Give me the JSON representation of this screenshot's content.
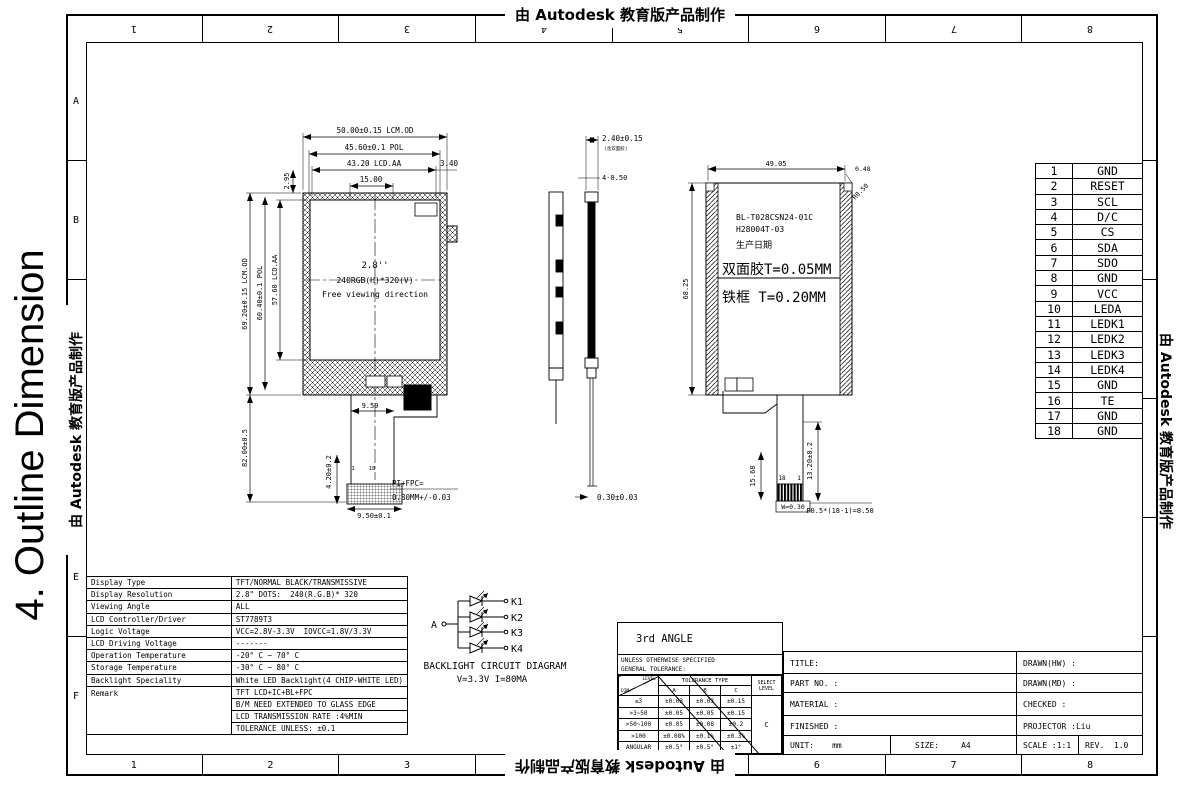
{
  "sheet": {
    "big_title": "4. Outline Dimension",
    "watermark": "由 Autodesk 教育版产品制作",
    "cols": [
      "1",
      "2",
      "3",
      "4",
      "5",
      "6",
      "7",
      "8"
    ],
    "rows": [
      "A",
      "B",
      "C",
      "D",
      "E",
      "F"
    ]
  },
  "front": {
    "dim_w_od": "50.00±0.15 LCM.OD",
    "dim_w_pol": "45.60±0.1 POL",
    "dim_w_aa": "43.20 LCD.AA",
    "dim_offset": "3.40",
    "dim_ledge": "15.00",
    "dim_top_gap": "2.95",
    "dim_h_od": "69.20±0.15 LCM.OD",
    "dim_h_pol": "60.40±0.1 POL",
    "dim_h_aa": "57.60 LCD.AA",
    "dim_h_total": "82.00±0.5",
    "size_label": "2.8''",
    "res_label": "240RGB(H)*320(V)",
    "view_label": "Free viewing direction",
    "dim_fpc_w": "9.50",
    "dim_fpc_h": "4.20±0.2",
    "dim_fpc_w2": "9.50±0.1",
    "fpc_note1": "PI+FPC=",
    "fpc_note2": "0.30MM+/-0.03",
    "pin_first": "1",
    "pin_last": "18"
  },
  "side": {
    "dim_thickness": "2.40±0.15",
    "dim_thickness_note": "(含双面胶)",
    "dim_bumps": "4-0.50",
    "dim_fpc_t": "0.30±0.03"
  },
  "rear": {
    "dim_top": "49.05",
    "dim_corner": "0.48",
    "dim_radius": "R0.50",
    "dim_left": "68.25",
    "model1": "BL-T028CSN24-01C",
    "model2": "H28004T-03",
    "model3": "生产日期",
    "tape": "双面胶T=0.05MM",
    "frame": "铁框 T=0.20MM",
    "dim_tail": "15.68",
    "dim_tail2": "13.20±0.2",
    "pin_left": "18",
    "pin_right": "1",
    "dim_w": "W=0.30",
    "dim_pitch": "P0.5*(18-1)=8.50"
  },
  "pins": [
    {
      "no": "1",
      "name": "GND"
    },
    {
      "no": "2",
      "name": "RESET"
    },
    {
      "no": "3",
      "name": "SCL"
    },
    {
      "no": "4",
      "name": "D/C"
    },
    {
      "no": "5",
      "name": "CS"
    },
    {
      "no": "6",
      "name": "SDA"
    },
    {
      "no": "7",
      "name": "SDO"
    },
    {
      "no": "8",
      "name": "GND"
    },
    {
      "no": "9",
      "name": "VCC"
    },
    {
      "no": "10",
      "name": "LEDA"
    },
    {
      "no": "11",
      "name": "LEDK1"
    },
    {
      "no": "12",
      "name": "LEDK2"
    },
    {
      "no": "13",
      "name": "LEDK3"
    },
    {
      "no": "14",
      "name": "LEDK4"
    },
    {
      "no": "15",
      "name": "GND"
    },
    {
      "no": "16",
      "name": "TE"
    },
    {
      "no": "17",
      "name": "GND"
    },
    {
      "no": "18",
      "name": "GND"
    }
  ],
  "specs": {
    "rows": [
      {
        "label": "Display Type",
        "value": "TFT/NORMAL BLACK/TRANSMISSIVE"
      },
      {
        "label": "Display Resolution",
        "value": "2.8\" DOTS:  240(R.G.B)* 320"
      },
      {
        "label": "Viewing Angle",
        "value": "ALL"
      },
      {
        "label": "LCD Controller/Driver",
        "value": "ST7789T3"
      },
      {
        "label": "Logic Voltage",
        "value": "VCC=2.8V-3.3V  IOVCC=1.8V/3.3V"
      },
      {
        "label": "LCD Driving Voltage",
        "value": "-------"
      },
      {
        "label": "Operation Temperature",
        "value": "-20° C ~ 70° C"
      },
      {
        "label": "Storage Temperature",
        "value": "-30° C ~ 80° C"
      },
      {
        "label": "Backlight Speciality",
        "value": "White LED Backlight(4 CHIP-WHITE LED)"
      }
    ],
    "remark_label": "Remark",
    "remark_rows": [
      "TFT LCD+IC+BL+FPC",
      "B/M NEED EXTENDED TO GLASS EDGE",
      "LCD TRANSMISSION RATE :4%MIN",
      "TOLERANCE UNLESS: ±0.1"
    ]
  },
  "backlight": {
    "a": "A",
    "k": [
      "K1",
      "K2",
      "K3",
      "K4"
    ],
    "title": "BACKLIGHT CIRCUIT DIAGRAM",
    "subtitle": "V=3.3V I=80MA"
  },
  "titleblock": {
    "angle": "3rd ANGLE",
    "note1": "UNLESS OTHERWISE SPECIFIED",
    "note2": "GENERAL TOLERANCE:",
    "level": "LEVEL",
    "dim": "DIM.",
    "tol_type": "TOLERANCE TYPE",
    "tol_cols": [
      "A",
      "B",
      "C"
    ],
    "select1": "SELECT",
    "select2": "LEVEL",
    "tol_rows": [
      {
        "range": "≤3",
        "a": "±0.03",
        "b": "±0.03",
        "c": "±0.15"
      },
      {
        "range": ">3~50",
        "a": "±0.05",
        "b": "±0.05",
        "c": "±0.15"
      },
      {
        "range": ">50~100",
        "a": "±0.05",
        "b": "±0.08",
        "c": "±0.2"
      },
      {
        "range": ">100",
        "a": "±0.08%",
        "b": "±0.1%",
        "c": "±0.3%"
      },
      {
        "range": "ANGULAR",
        "a": "±0.5°",
        "b": "±0.5°",
        "c": "±1°"
      }
    ],
    "select_value": "C",
    "title_label": "TITLE:",
    "part_label": "PART NO. :",
    "material_label": "MATERIAL :",
    "finished_label": "FINISHED :",
    "unit_label": "UNIT:",
    "unit_value": "mm",
    "size_label": "SIZE:",
    "size_value": "A4",
    "scale_label": "SCALE :1:1",
    "rev_label": "REV.  1.0",
    "drawn_hw": "DRAWN(HW) :",
    "drawn_md": "DRAWN(MD) :",
    "checked": "CHECKED :",
    "projector": "PROJECTOR :Liu"
  }
}
